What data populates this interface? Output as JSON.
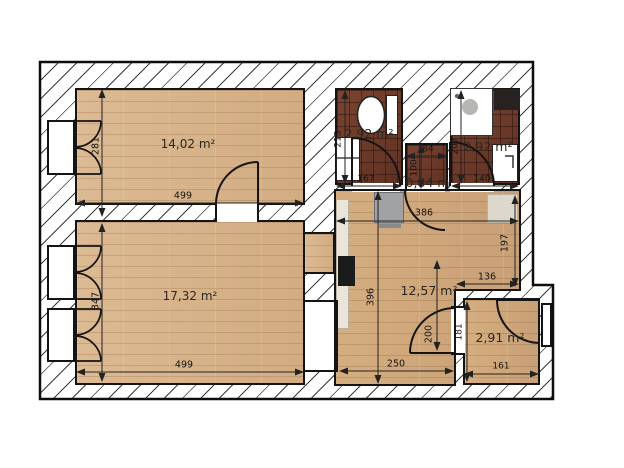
{
  "plan": {
    "rooms": {
      "living": {
        "area": "14,02 m²",
        "width": "499",
        "height": "281"
      },
      "bedroom": {
        "area": "17,32 m²",
        "width": "499",
        "height": "347"
      },
      "bath_left": {
        "area": "2,92 m²",
        "width": "167",
        "height": "213"
      },
      "wc": {
        "area": "0,84 m²",
        "width": "84",
        "height": "100"
      },
      "bath_right": {
        "area": "2,92 m²",
        "width": "140",
        "height": "207"
      },
      "kitchen": {
        "area": "12,57 m²",
        "width_top": "386",
        "height_left": "396",
        "height_right": "197",
        "width_mid": "136",
        "width_bottom": "250",
        "height_door": "200"
      },
      "storage": {
        "area": "2,91 m²",
        "width": "161",
        "height": "181"
      }
    },
    "colors": {
      "wood_floor": "#d8b58d",
      "wood_floor_dark": "#cfa87c",
      "tile_floor": "#6e3b2a",
      "wall_fill": "#ffffff",
      "line": "#141414"
    }
  }
}
